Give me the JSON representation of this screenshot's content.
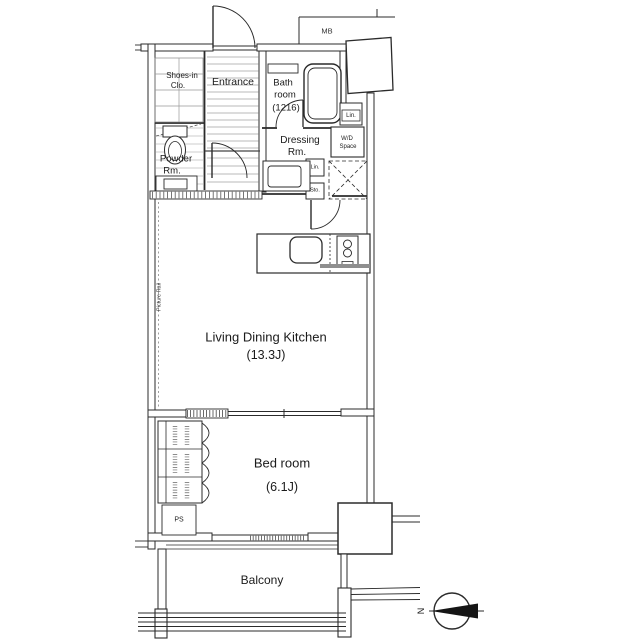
{
  "labels": {
    "mb": "MB",
    "shoes1": "Shoes-in",
    "shoes2": "Clo.",
    "entrance": "Entrance",
    "bath1": "Bath",
    "bath2": "room",
    "bath3": "(1216)",
    "lin_upper": "Lin.",
    "wd1": "W/D",
    "wd2": "Space",
    "dress1": "Dressing",
    "dress2": "Rm.",
    "powder1": "Powder",
    "powder2": "Rm.",
    "lin_lower": "Lin.",
    "sto": "Sto.",
    "ldk": "Living Dining Kitchen",
    "ldk_size": "(13.3J)",
    "picture_rail": "Picture Rail",
    "bed": "Bed room",
    "bed_size": "(6.1J)",
    "ps": "PS",
    "balcony": "Balcony",
    "north": "N"
  },
  "palette": {
    "line": "#2b2b2b",
    "text": "#1b1b1b",
    "background": "#ffffff",
    "counter_bar": "#8f8f8f"
  }
}
